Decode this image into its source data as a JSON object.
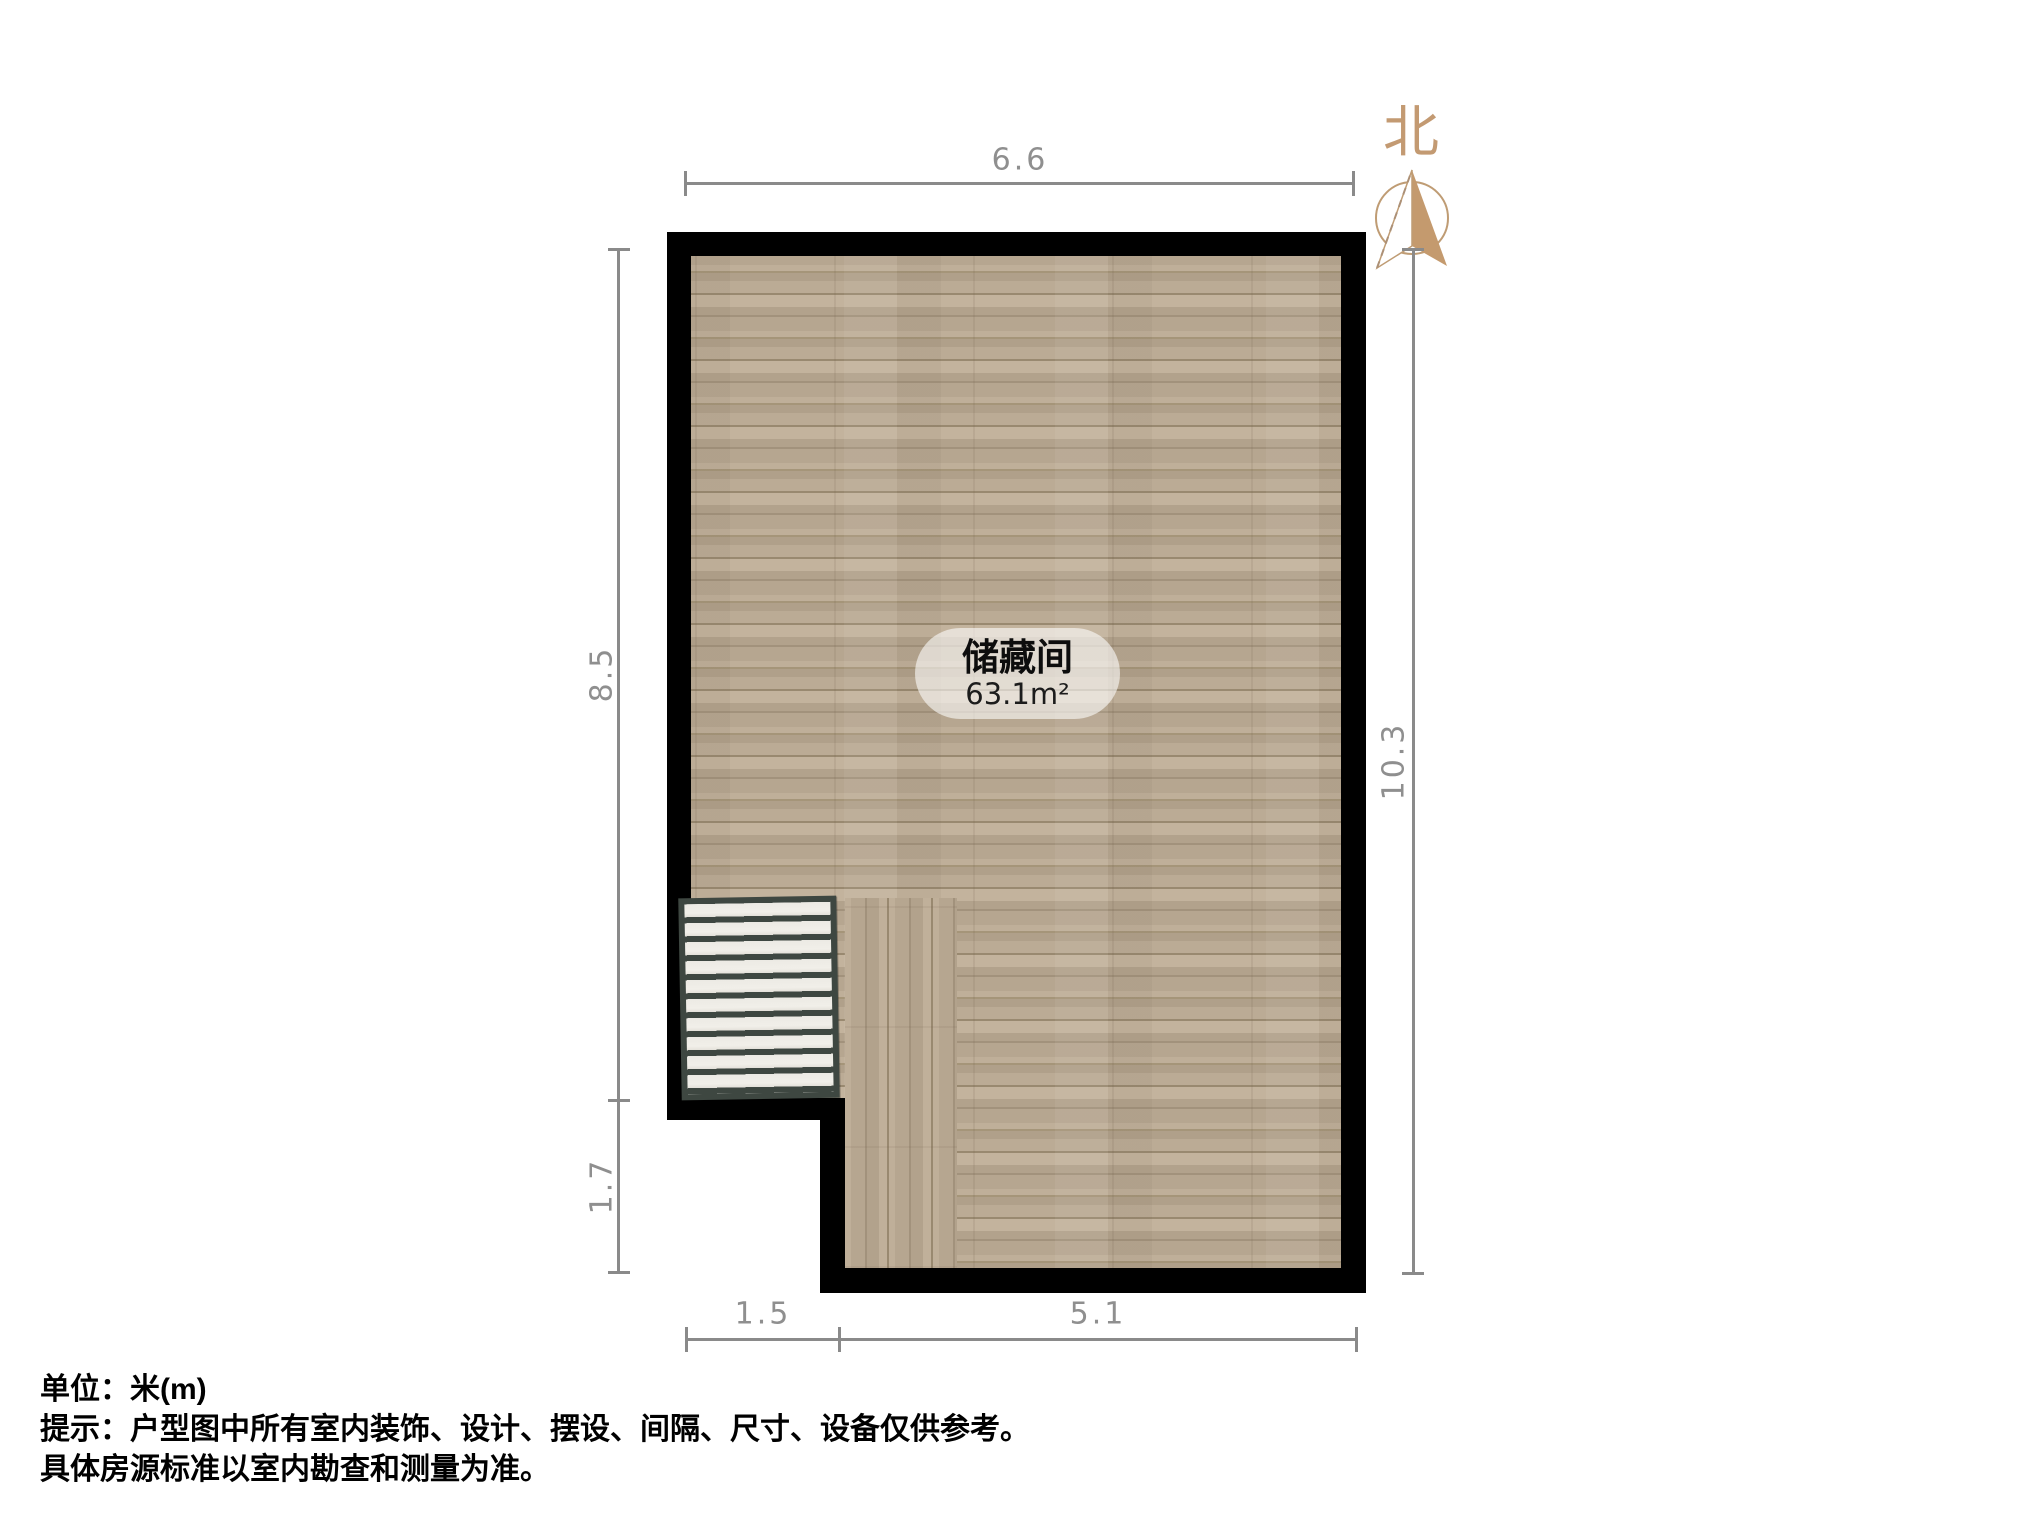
{
  "plan": {
    "room": {
      "name": "储藏间",
      "area": "63.1m²"
    },
    "dimensions": {
      "top": "6.6",
      "left_upper": "8.5",
      "left_lower": "1.7",
      "right": "10.3",
      "bottom_left": "1.5",
      "bottom_right": "5.1"
    },
    "north_label": "北",
    "colors": {
      "wall": "#000000",
      "floor_base": "#b7a791",
      "dimension_gray": "#8a8a8a",
      "north_tan": "#c39a72",
      "stair_frame": "#3e4741",
      "stair_tread": "#eceae4",
      "room_pill": "rgba(255,255,255,0.58)"
    }
  },
  "footer": {
    "line1": "单位：米(m)",
    "line2": "提示：户型图中所有室内装饰、设计、摆设、间隔、尺寸、设备仅供参考。",
    "line3": "具体房源标准以室内勘查和测量为准。"
  }
}
